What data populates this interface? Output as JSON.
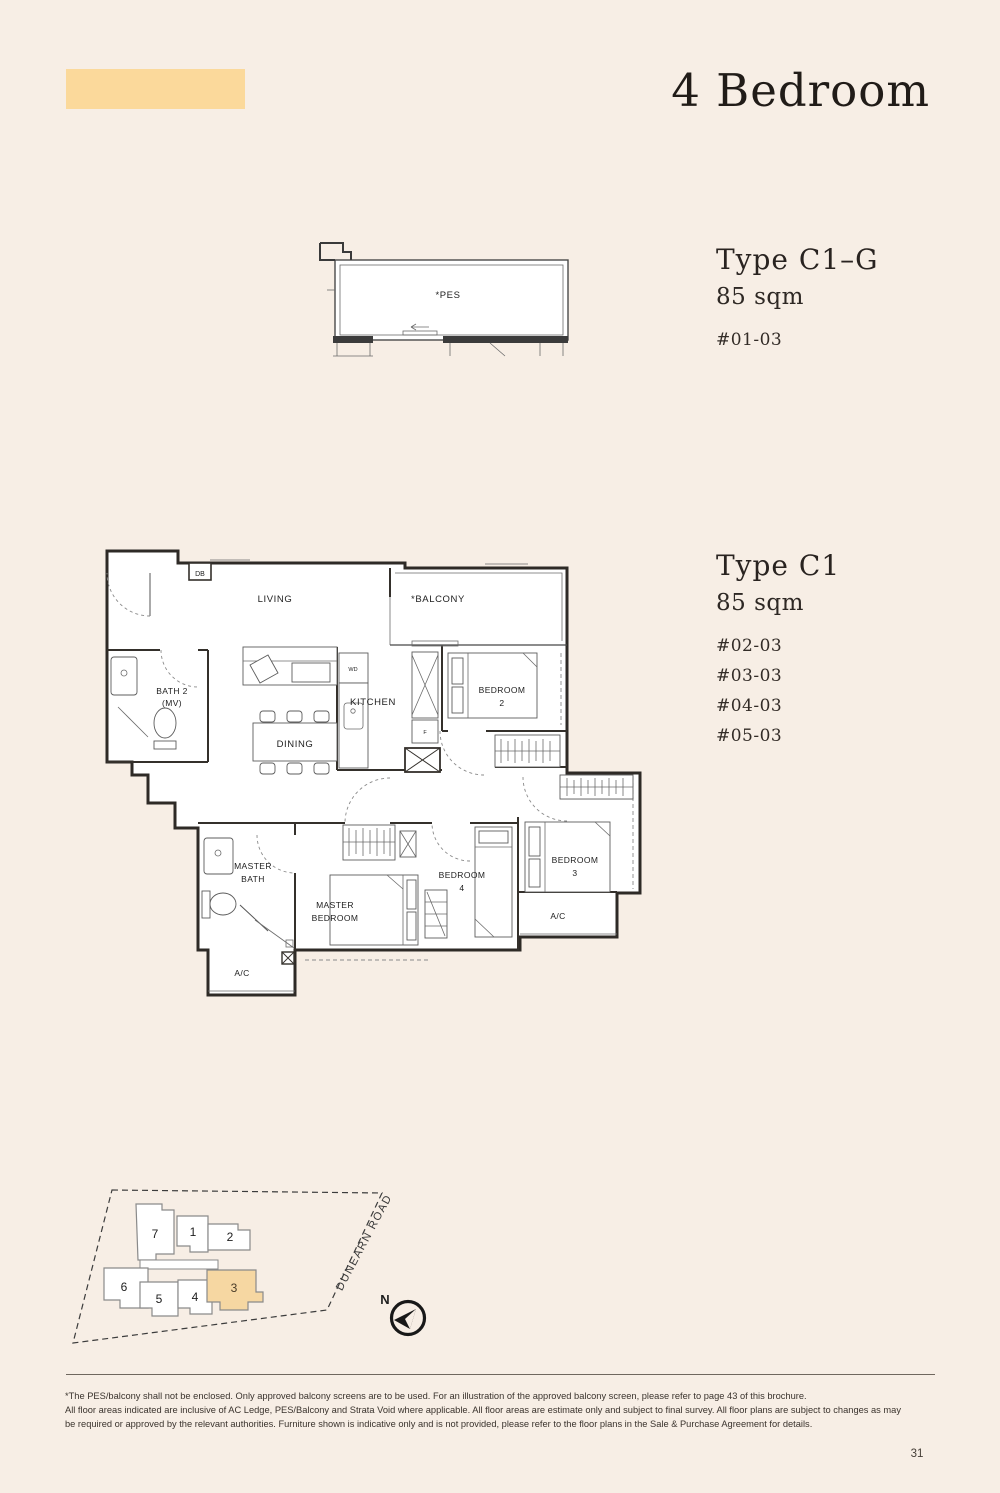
{
  "page": {
    "background": "#f7eee5",
    "accent_swatch": "#fbd99b",
    "highlight_fill": "#f6d7a2",
    "page_number": "31"
  },
  "header": {
    "title": "4 Bedroom"
  },
  "pes_plan": {
    "label": "*PES"
  },
  "unit_c1g": {
    "type_label": "Type C1–G",
    "area_label": "85 sqm",
    "stacks": [
      "#01-03"
    ]
  },
  "unit_c1": {
    "type_label": "Type C1",
    "area_label": "85 sqm",
    "stacks": [
      "#02-03",
      "#03-03",
      "#04-03",
      "#05-03"
    ]
  },
  "floor_plan": {
    "labels": {
      "db": "DB",
      "living": "LIVING",
      "balcony": "*BALCONY",
      "bath2_line1": "BATH 2",
      "bath2_line2": "(MV)",
      "kitchen": "KITCHEN",
      "wd": "WD",
      "fridge": "F",
      "dining": "DINING",
      "bedroom2_line1": "BEDROOM",
      "bedroom2_line2": "2",
      "bedroom3_line1": "BEDROOM",
      "bedroom3_line2": "3",
      "bedroom4_line1": "BEDROOM",
      "bedroom4_line2": "4",
      "master_bath_line1": "MASTER",
      "master_bath_line2": "BATH",
      "master_bedroom_line1": "MASTER",
      "master_bedroom_line2": "BEDROOM",
      "ac_left": "A/C",
      "ac_right": "A/C"
    }
  },
  "site_plan": {
    "buildings": [
      "1",
      "2",
      "3",
      "4",
      "5",
      "6",
      "7"
    ],
    "highlighted_building": "3",
    "road_label": "DUNEARN ROAD",
    "north_label": "N"
  },
  "footer": {
    "disclaimer_lines": [
      "*The PES/balcony shall not be enclosed. Only approved balcony screens are to be used. For an illustration of the approved balcony screen, please refer to page 43 of this brochure.",
      "All floor areas indicated are inclusive of AC Ledge, PES/Balcony and Strata Void where applicable. All floor areas are estimate only and subject to final survey. All floor plans are subject to changes as may",
      "be required or approved by the relevant authorities. Furniture shown is indicative only and is not provided, please refer to the floor plans in the Sale & Purchase Agreement for details."
    ]
  }
}
